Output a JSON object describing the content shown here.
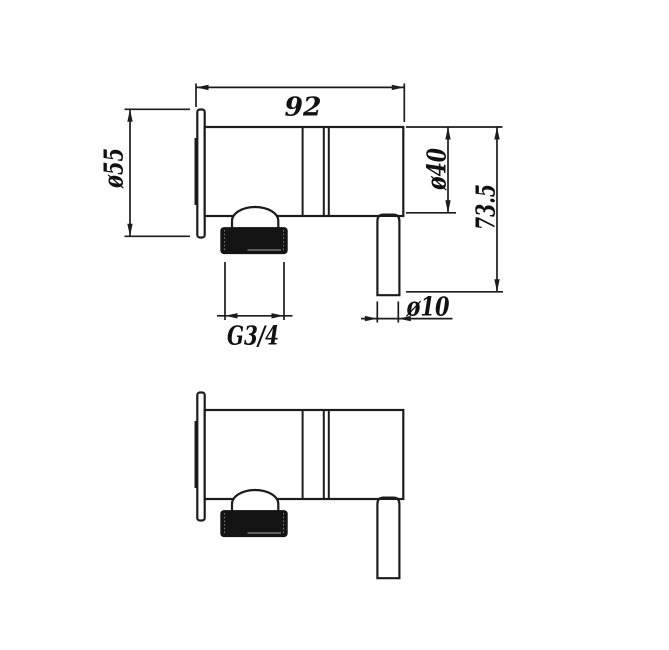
{
  "document": {
    "kind": "technical-drawing",
    "background_color": "#ffffff",
    "line_color": "#1c1c1c"
  },
  "dimensions": {
    "body_length": "92",
    "flange_diameter": "ø55",
    "body_diameter": "ø40",
    "overall_height": "73.5",
    "outlet_diameter": "ø10",
    "thread_size": "G3/4"
  }
}
